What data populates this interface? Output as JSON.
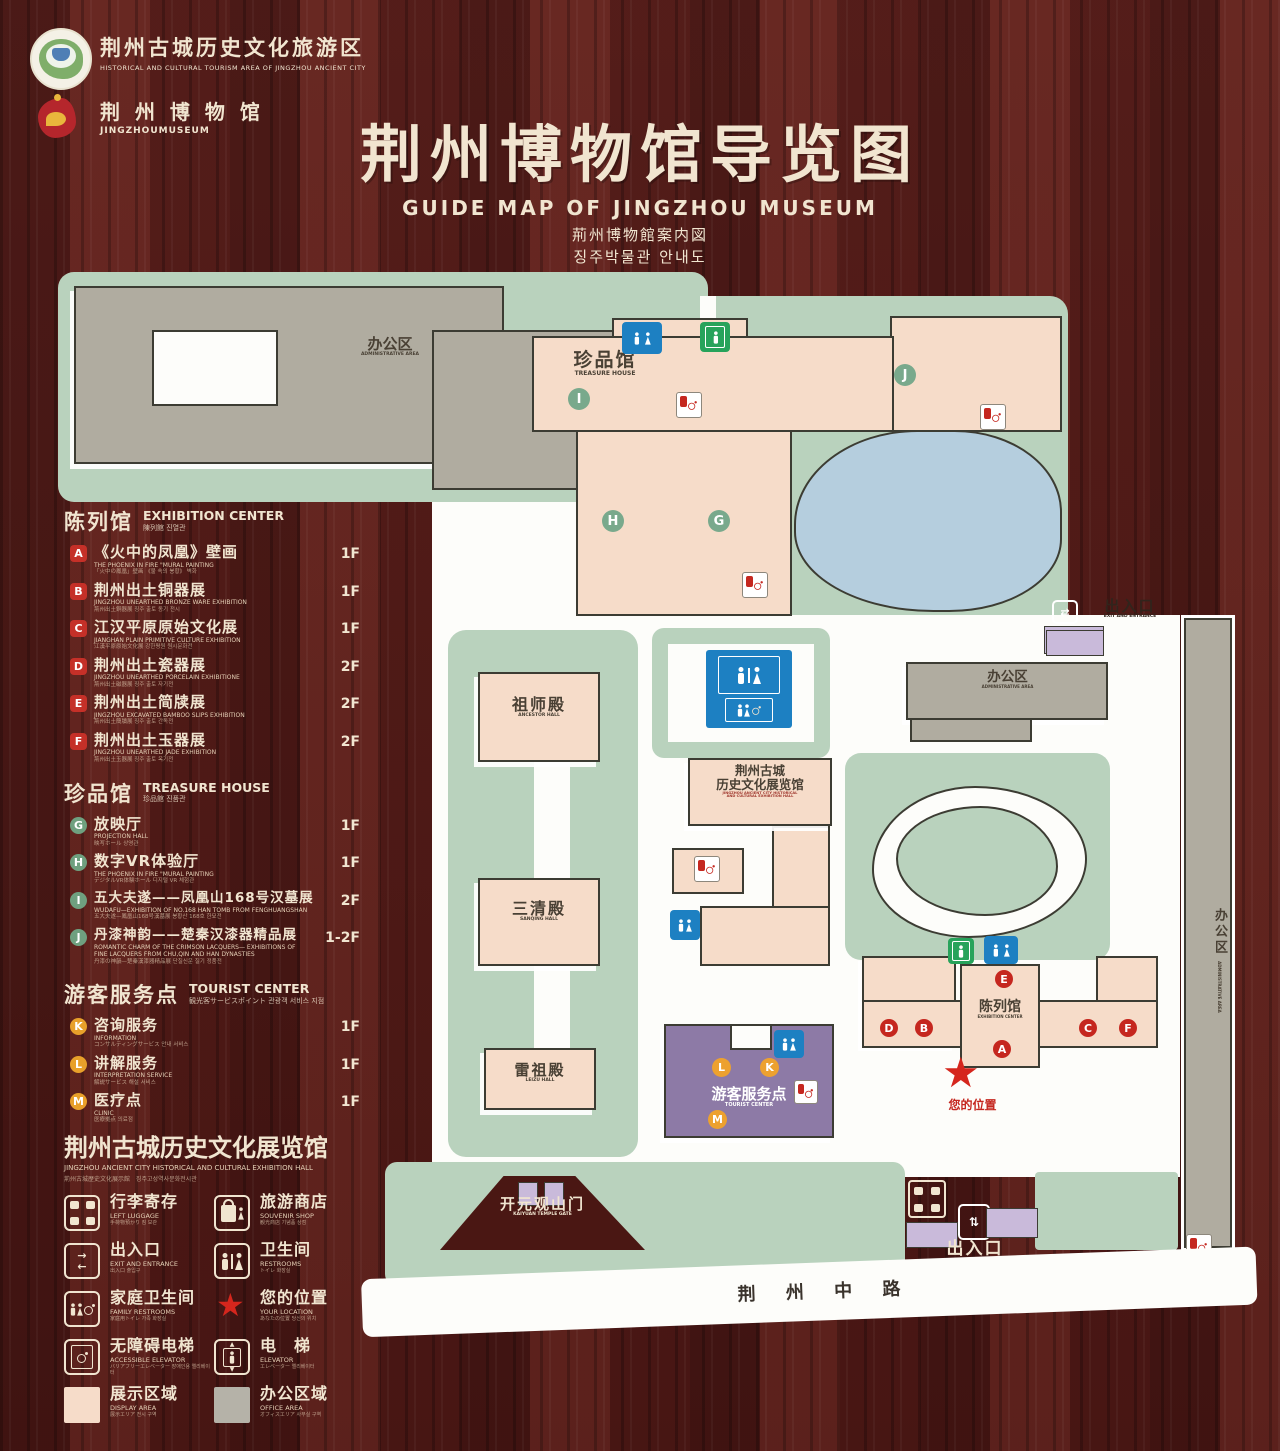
{
  "header": {
    "logo1_title": "荆州古城历史文化旅游区",
    "logo1_sub": "HISTORICAL AND CULTURAL TOURISM AREA OF JINGZHOU ANCIENT CITY",
    "logo2_title": "荆 州 博 物 馆",
    "logo2_sub": "JINGZHOUMUSEUM",
    "title": "荆州博物馆导览图",
    "subtitle_en": "GUIDE MAP OF JINGZHOU MUSEUM",
    "subtitle_ja": "荊州博物館案内図",
    "subtitle_ko": "징주박물관 안내도"
  },
  "legend": {
    "sections": [
      {
        "cn": "陈列馆",
        "en": "EXHIBITION CENTER",
        "sub": "陳列館  진열관",
        "items": [
          {
            "key": "A",
            "cn": "《火中的凤凰》壁画",
            "en": "THE PHOENIX IN FIRE \"MURAL PAINTING",
            "sub": "「火中の鳳凰」壁画 《불 속의 봉황》 벽화",
            "floor": "1F"
          },
          {
            "key": "B",
            "cn": "荆州出土铜器展",
            "en": "JINGZHOU UNEARTHED BRONZE WARE EXHIBITION",
            "sub": "荊州出土銅器展 징주 출토 동기 전시",
            "floor": "1F"
          },
          {
            "key": "C",
            "cn": "江汉平原原始文化展",
            "en": "JIANGHAN PLAIN PRIMITIVE CULTURE EXHIBITION",
            "sub": "江漢平原原始文化展 강한평원 원시문화전",
            "floor": "1F"
          },
          {
            "key": "D",
            "cn": "荆州出土瓷器展",
            "en": "JINGZHOU UNEARTHED PORCELAIN EXHIBITIONE",
            "sub": "荊州出土磁器展 징주 출토 자기전",
            "floor": "2F"
          },
          {
            "key": "E",
            "cn": "荆州出土简牍展",
            "en": "JINGZHOU EXCAVATED BAMBOO SLIPS EXHIBITION",
            "sub": "荊州出土簡牘展 징주 출토 간독전",
            "floor": "2F"
          },
          {
            "key": "F",
            "cn": "荆州出土玉器展",
            "en": "JINGZHOU UNEARTHED JADE EXHIBITION",
            "sub": "荊州出土玉器展 징주 출토 옥기전",
            "floor": "2F"
          }
        ]
      },
      {
        "cn": "珍品馆",
        "en": "TREASURE HOUSE",
        "sub": "珍品館  진품관",
        "items": [
          {
            "key": "G",
            "cn": "放映厅",
            "en": "PROJECTION HALL",
            "sub": "映写ホール 상영관",
            "floor": "1F"
          },
          {
            "key": "H",
            "cn": "数字VR体验厅",
            "en": "THE PHOENIX IN FIRE \"MURAL PAINTING",
            "sub": "デジタルVR体験ホール 디지털 VR 체험관",
            "floor": "1F"
          },
          {
            "key": "I",
            "cn": "五大夫遂——凤凰山168号汉墓展",
            "en": "WUDAFU—EXHIBITION OF NO.168 HAN TOMB FROM FENGHUANGSHAN",
            "sub": "五大夫遂—鳳凰山168号漢墓展 봉황산 168호 한묘전",
            "floor": "2F"
          },
          {
            "key": "J",
            "cn": "丹漆神韵——楚秦汉漆器精品展",
            "en": "ROMANTIC CHARM OF THE CRIMSON LACQUERS— EXHIBITIONS OF FINE LACQUERS FROM CHU,QIN AND HAN DYNASTIES",
            "sub": "丹漆の神韻—楚秦漢漆器精品展 단칠신운 칠기 정품전",
            "floor": "1-2F"
          }
        ]
      },
      {
        "cn": "游客服务点",
        "en": "TOURIST CENTER",
        "sub": "観光客サービスポイント  관광객 서비스 지점",
        "items": [
          {
            "key": "K",
            "cn": "咨询服务",
            "en": "INFORMATION",
            "sub": "コンサルティングサービス 안내 서비스",
            "floor": "1F"
          },
          {
            "key": "L",
            "cn": "讲解服务",
            "en": "INTERPRETATION SERVICE",
            "sub": "解説サービス 해설 서비스",
            "floor": "1F"
          },
          {
            "key": "M",
            "cn": "医疗点",
            "en": "CLINIC",
            "sub": "医療拠点 의료점",
            "floor": "1F"
          }
        ]
      }
    ],
    "hall_note": {
      "cn": "荆州古城历史文化展览馆",
      "en": "JINGZHOU ANCIENT CITY HISTORICAL AND CULTURAL EXHIBITION HALL",
      "sub": "荊州古城歴史文化展示館　징주고성역사문화전시관"
    },
    "icons": [
      {
        "cn": "行李寄存",
        "en": "LEFT LUGGAGE",
        "sub": "手荷物預かり 짐 보관"
      },
      {
        "cn": "旅游商店",
        "en": "SOUVENIR SHOP",
        "sub": "観光商店 기념품 상점"
      },
      {
        "cn": "出入口",
        "en": "EXIT AND ENTRANCE",
        "sub": "出入口 출입구"
      },
      {
        "cn": "卫生间",
        "en": "RESTROOMS",
        "sub": "トイレ 화장실"
      },
      {
        "cn": "家庭卫生间",
        "en": "FAMILY RESTROOMS",
        "sub": "家庭用トイレ 가족 화장실"
      },
      {
        "cn": "您的位置",
        "en": "YOUR LOCATION",
        "sub": "あなたの位置 당신의 위치"
      },
      {
        "cn": "无障碍电梯",
        "en": "ACCESSIBLE ELEVATOR",
        "sub": "バリアフリーエレベーター 장애인용 엘리베이터"
      },
      {
        "cn": "电　梯",
        "en": "ELEVATOR",
        "sub": "エレベーター 엘리베이터"
      },
      {
        "cn": "展示区域",
        "en": "DISPLAY AREA",
        "sub": "展示エリア 전시 구역"
      },
      {
        "cn": "办公区域",
        "en": "OFFICE AREA",
        "sub": "オフィスエリア 사무실 구역"
      }
    ]
  },
  "map": {
    "admin_nw": {
      "cn": "办公区",
      "en": "ADMINISTRATIVE AREA"
    },
    "treasure": {
      "cn": "珍品馆",
      "en": "TREASURE HOUSE"
    },
    "admin_east": {
      "cn": "办公区",
      "en": "ADMINISTRATIVE AREA"
    },
    "admin_strip": {
      "cn": "办公区",
      "en": "ADMINISTRATIVE AREA"
    },
    "ancestor_hall": {
      "cn": "祖师殿",
      "en": "ANCESTOR HALL"
    },
    "sanqing_hall": {
      "cn": "三清殿",
      "en": "SANQING HALL"
    },
    "leizu_hall": {
      "cn": "雷祖殿",
      "en": "LEIZU HALL"
    },
    "history_hall": {
      "cn1": "荆州古城",
      "cn2": "历史文化展览馆",
      "en1": "JINGZHOU ANCIENT CITY HISTORICAL",
      "en2": "AND CULTURAL EXHIBITION HALL"
    },
    "exhibition_center": {
      "cn": "陈列馆",
      "en": "EXHIBITION CENTER"
    },
    "tourist_center": {
      "cn": "游客服务点",
      "en": "TOURIST CENTER"
    },
    "east_entrance": {
      "cn": "出入口",
      "en": "EXIT AND ENTRANCE"
    },
    "south_entrance": {
      "cn": "出入口",
      "en": "EXIT AND ENTRANCE"
    },
    "gate": {
      "cn": "开元观山门",
      "en": "KAIYUAN TEMPLE GATE"
    },
    "road": "荆 州 中 路",
    "your_location": "您的位置",
    "markers": {
      "A": "A",
      "B": "B",
      "C": "C",
      "D": "D",
      "E": "E",
      "F": "F",
      "G": "G",
      "H": "H",
      "I": "I",
      "J": "J",
      "K": "K",
      "L": "L",
      "M": "M"
    }
  },
  "colors": {
    "wood": "#551e1b",
    "cream": "#f1e5d0",
    "map_green": "#b9d2bd",
    "building_pink": "#f6dcc9",
    "building_gray": "#b0aca0",
    "pond_blue": "#b5cede",
    "tourist_purple": "#8d7aa6",
    "entrance_lilac": "#c9bada",
    "marker_red": "#c5271f",
    "marker_green": "#79a98c",
    "marker_orange": "#eda12f",
    "restroom_blue": "#1d80c2",
    "elevator_green": "#27a35b",
    "star_red": "#d5261d"
  }
}
